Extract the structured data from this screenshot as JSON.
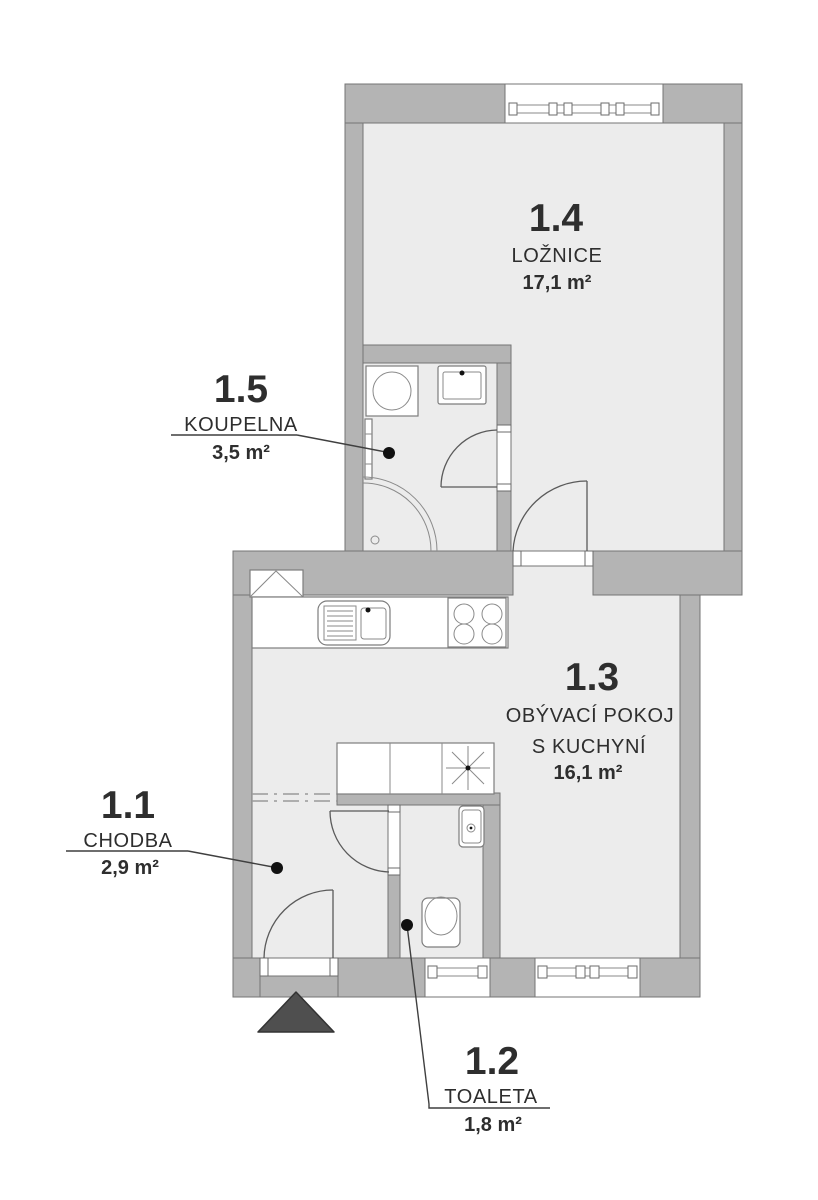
{
  "floorplan": {
    "rooms": [
      {
        "id": "1.1",
        "name": "CHODBA",
        "area": "2,9 m²"
      },
      {
        "id": "1.2",
        "name": "TOALETA",
        "area": "1,8 m²"
      },
      {
        "id": "1.3",
        "name": "OBÝVACÍ POKOJ",
        "name_line2": "S KUCHYNÍ",
        "area": "16,1 m²"
      },
      {
        "id": "1.4",
        "name": "LOŽNICE",
        "area": "17,1 m²"
      },
      {
        "id": "1.5",
        "name": "KOUPELNA",
        "area": "3,5 m²"
      }
    ],
    "colors": {
      "background": "#ffffff",
      "wall": "#b4b4b4",
      "wall_outline": "#757575",
      "floor": "#ececec",
      "fixture_outline": "#7d7d7d",
      "text": "#2e2e2e",
      "entrance_arrow": "#4f4f4f"
    }
  }
}
